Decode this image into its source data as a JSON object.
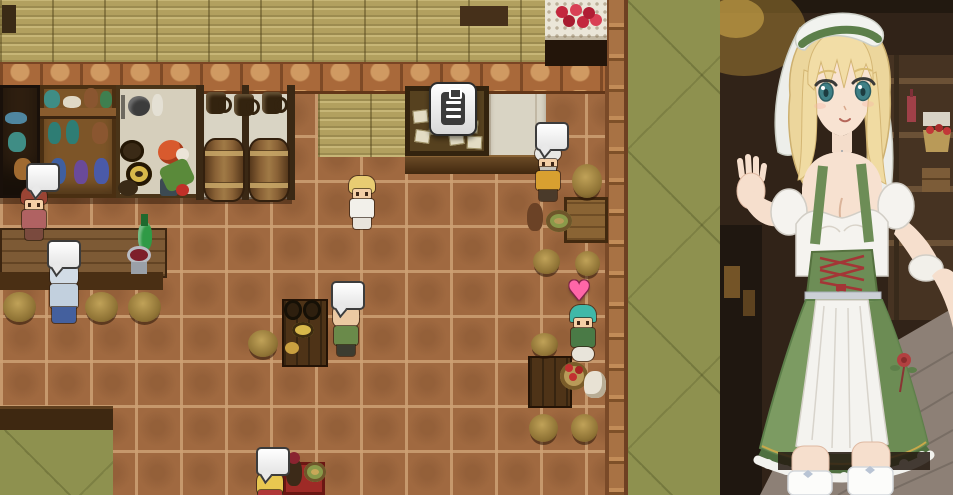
{
  "window": {
    "kind": "game-screenshot",
    "description": "Top-down RPG Maker style tavern interior with sprites, speech bubbles and a large barmaid portrait on the right side"
  },
  "game": {
    "map_label": "Tavern interior",
    "floor_label": "Terracotta tile floor",
    "green_floor_label": "Olive green floor area",
    "icons": {
      "speech_bubble": "speech bubble (talk indicator)",
      "clipboard": "quest board clipboard icon",
      "heart": "♥"
    },
    "npcs": [
      {
        "id": "red-haired-villager",
        "label": "Red-haired villager with speech bubble"
      },
      {
        "id": "blue-robed-patron",
        "label": "Blue-robed patron seated at the bar counter"
      },
      {
        "id": "player-barmaid",
        "label": "Blonde barmaid in white dress (player character)"
      },
      {
        "id": "bald-patron",
        "label": "Balding patron in green at the keg table"
      },
      {
        "id": "turbaned-merchant",
        "label": "Turbaned merchant with speech bubble"
      },
      {
        "id": "green-haired-adventurer",
        "label": "Green-haired adventurer with heart indicator"
      },
      {
        "id": "blonde-patron",
        "label": "Blonde patron at bottom table with speech bubble"
      }
    ],
    "objects": {
      "quest_board": "Bulletin board with posted notes",
      "dish_cabinet": "Dark cabinet with blue dishes and pots",
      "jar_shelf": "Shelf with jars, bottles and vases",
      "kitchen_counter": "Kitchen counter with pans, pickle kegs and vegetables",
      "mug_rack": "Hanging mugs on white wall",
      "storage_barrels": "Two storage barrels",
      "rose_table": "Table with red roses on lace cloth",
      "bar_counter": "Bar counter with wine cup and green bottle",
      "barrel_table": "Table with kegs and yellow plate",
      "dining_table": "Dining table with stools",
      "apple_basket": "Basket of apples",
      "flour_sack": "White sack",
      "red_table": "Red-cloth table with jug and plate",
      "bench": "Dark wood bench edge",
      "pillar": "Brick pillar"
    }
  },
  "portrait": {
    "label": "Barmaid in green dirndl with white apron, off-shoulder blouse and white head veil",
    "setting": "Dim tavern background with wooden shelves, bottle, apple basket and plank floor",
    "colors": {
      "hair": "#ecd69c",
      "eyes": "#3f8086",
      "dress": "#7c9b62",
      "apron": "#f4f3ef",
      "corset_lacing": "#a33636",
      "veil": "#f2f3ef",
      "skin": "#f7e1d0",
      "background": "#312318"
    }
  },
  "colors": {
    "tile_floor": "#a06940",
    "tile_grout": "#cda073",
    "straw_wall": "#b2a05f",
    "brick": "#a9693a",
    "green_floor": "#8e914f",
    "wood_dark": "#4a3018",
    "white_wall": "#d9d4c4"
  }
}
